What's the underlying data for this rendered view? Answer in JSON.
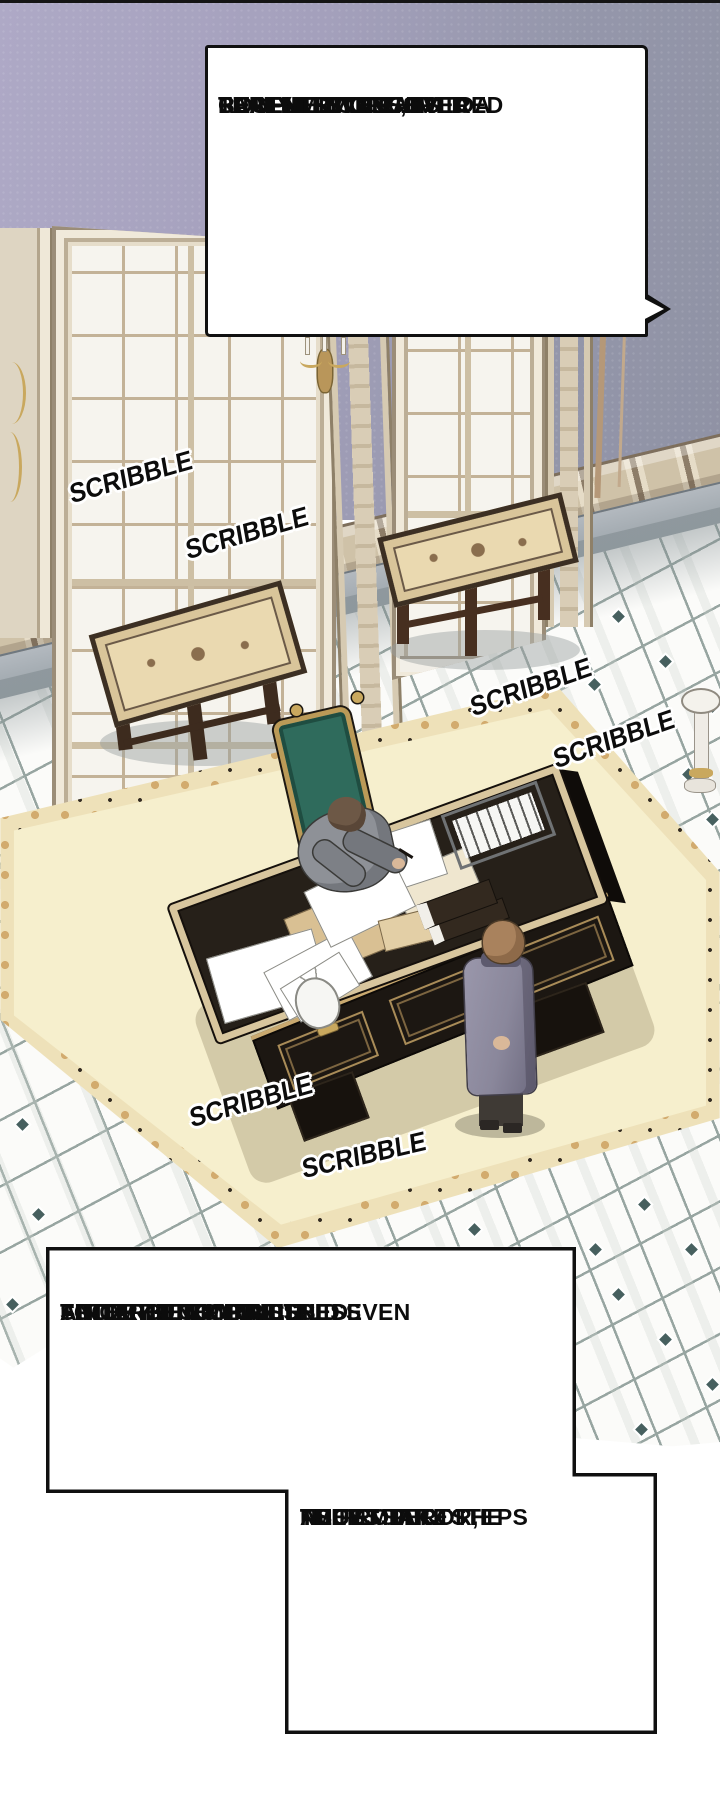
{
  "bubbles": {
    "top": {
      "lines": [
        "FURTHERMORE, I",
        "RECENTLY DISCOVERED",
        "THAT HE EVEN HIRED A",
        "COUPLE TO CLAIM TO",
        "BE MY MISTRESS'S",
        "PARENTS."
      ]
    },
    "bottom_left": {
      "lines": [
        "SINCE HE CONTINUES",
        "TO TARGET MY MISTRESS",
        "AND MY UNBORN CHILD EVEN",
        "AFTER BEING BANISHED",
        "FROM THE EMPIRE..."
      ]
    },
    "bottom_right": {
      "lines": [
        "AS",
        "THE EMPEROR,",
        "I MUST TAKE THE",
        "NECESSARY STEPS",
        "TO PROTECT",
        "THEM."
      ]
    }
  },
  "sfx": {
    "items": [
      "SCRIBBLE",
      "SCRIBBLE",
      "SCRIBBLE",
      "SCRIBBLE",
      "SCRIBBLE",
      "SCRIBBLE"
    ]
  },
  "scene": {
    "description": "Isometric palace study: emperor writing at ornate black desk, attendant standing before it",
    "colors": {
      "wall_lavender": "#a4a0bc",
      "floor_tile": "#fbfbf9",
      "tile_accent": "#47605f",
      "carpet_field": "#f6efcd",
      "carpet_border_gold": "#d2ab6e",
      "desk_black": "#262019",
      "desk_trim_gold": "#d8c69e",
      "chair_green": "#2f6b5c",
      "frame_cream": "#e6ddca",
      "sconce_gold": "#c9a85e"
    }
  }
}
